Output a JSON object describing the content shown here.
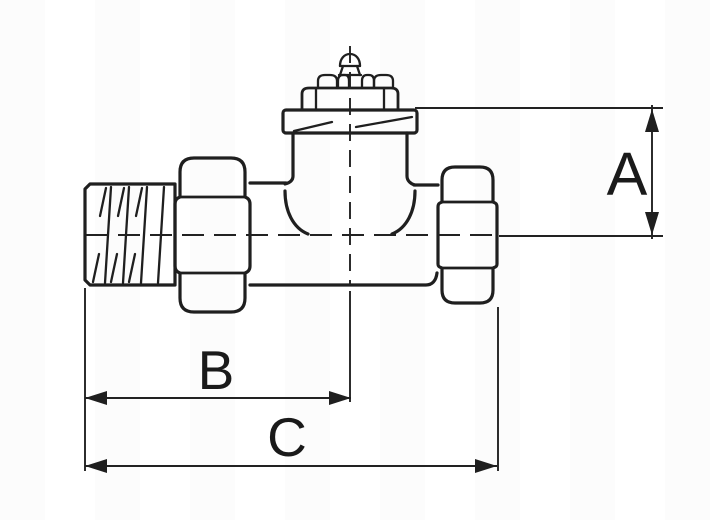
{
  "drawing": {
    "type": "technical dimension drawing",
    "subject": "straight radiator valve, side view with male thread, two union nuts, bonnet and spindle",
    "background_color": "#ffffff",
    "line_color": "#1f1f1f"
  },
  "dimension_labels": {
    "a": "A",
    "b": "B",
    "c": "C"
  }
}
